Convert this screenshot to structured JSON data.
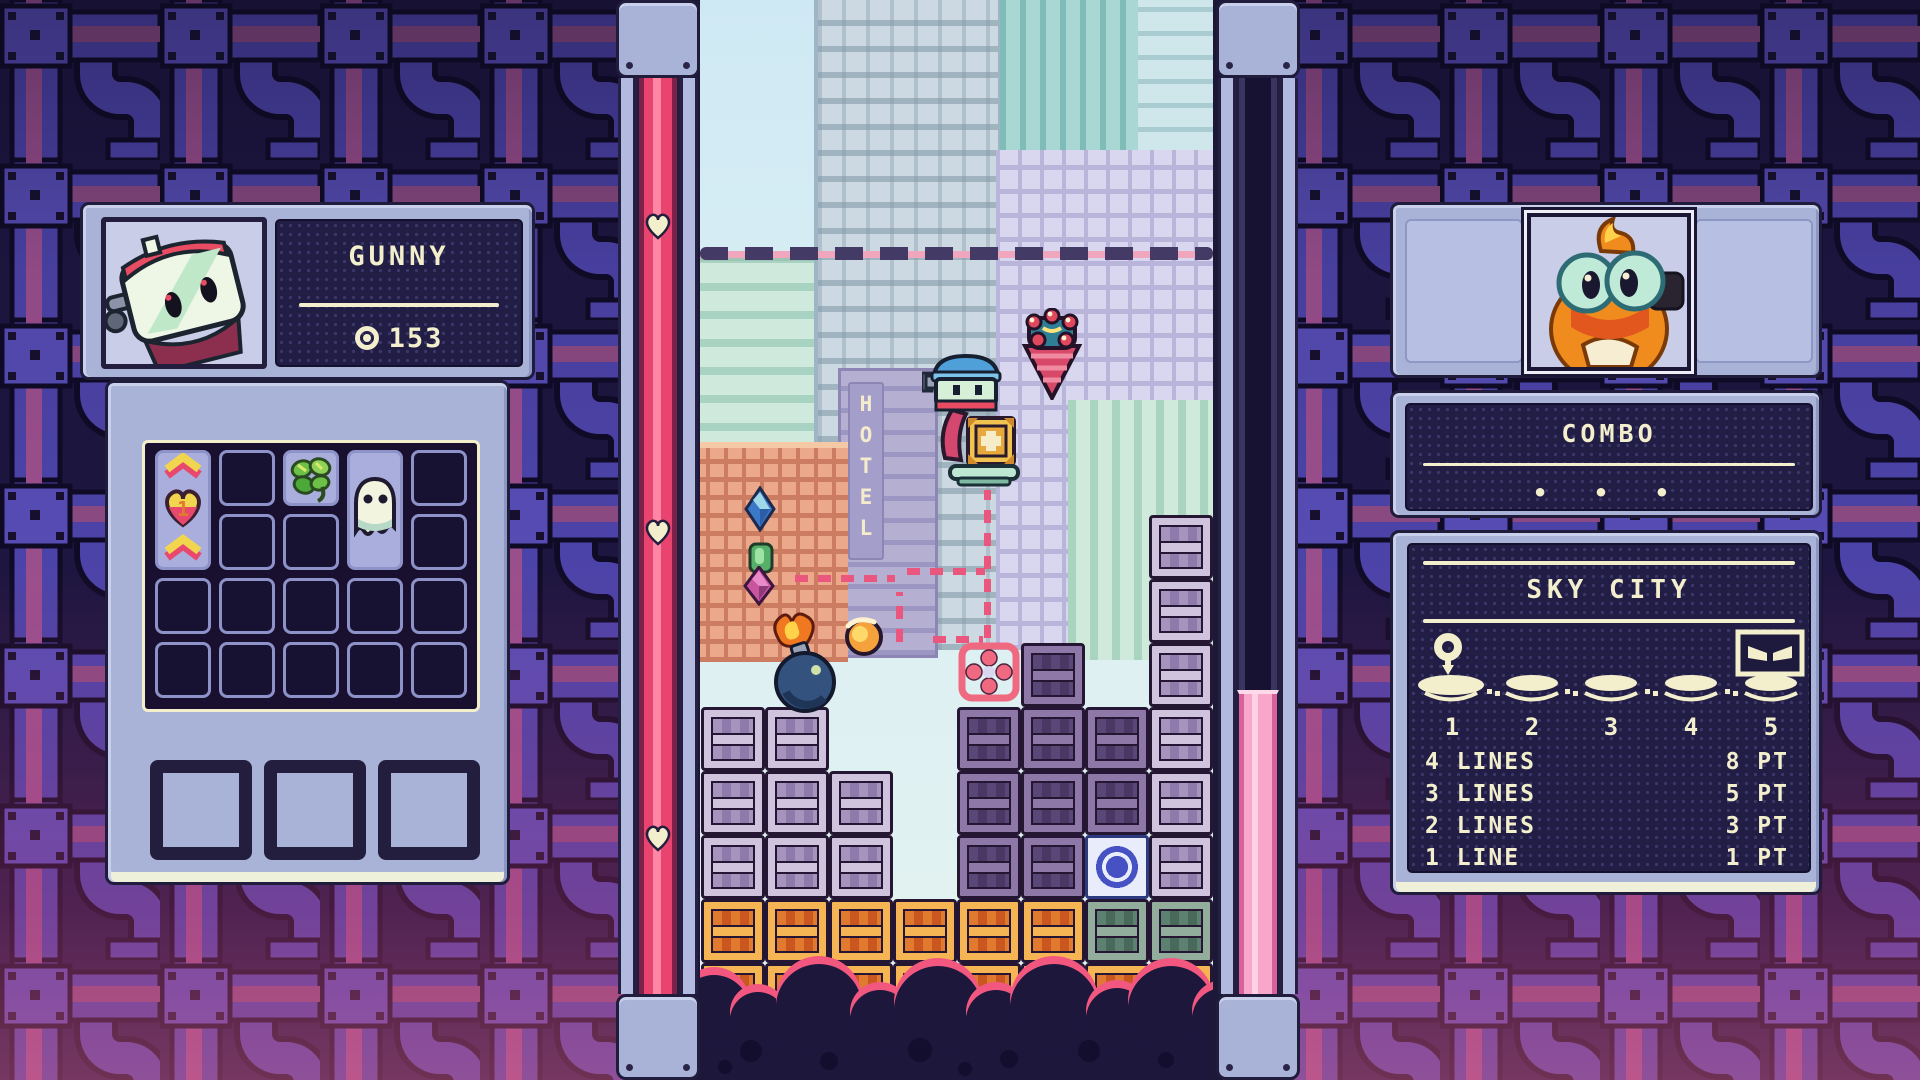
{
  "left_player": {
    "name": "GUNNY",
    "score": "153",
    "score_icon": "target-coin-icon",
    "heart_item_value": "1",
    "inventory_items": [
      "boost-chevrons-heart",
      "clover",
      "ghost"
    ]
  },
  "right_player": {
    "combo_label": "COMBO",
    "combo_dots": "•  •  •"
  },
  "stage": {
    "name": "SKY CITY",
    "checkpoints": [
      "1",
      "2",
      "3",
      "4",
      "5"
    ],
    "current_checkpoint": "1",
    "boss_at": "5",
    "scoring": [
      {
        "lines": "4 LINES",
        "points": "8 PT"
      },
      {
        "lines": "3 LINES",
        "points": "5 PT"
      },
      {
        "lines": "2 LINES",
        "points": "3 PT"
      },
      {
        "lines": "1 LINE",
        "points": "1 PT"
      }
    ]
  },
  "meters": {
    "left": {
      "type": "health-meter",
      "hearts": 3,
      "fill": "full-pink"
    },
    "right": {
      "type": "charge-meter",
      "fill_percent": 33,
      "fill": "pink-bottom"
    }
  },
  "field": {
    "hotel_sign": "HOTEL",
    "entities": [
      "player-robot",
      "plus-crate",
      "hover-platform",
      "drill-item",
      "bomb",
      "fireball",
      "gem-blue",
      "gem-green",
      "gem-pink",
      "target-reticle",
      "drop-path",
      "danger-line"
    ],
    "board": {
      "cols": 8,
      "block_types": {
        "lp": "light-purple",
        "dp": "dark-purple",
        "or": "orange",
        "gr": "green",
        "sp": "blue-special"
      },
      "blocks": [
        [
          1,
          3,
          "lp"
        ],
        [
          1,
          4,
          "lp"
        ],
        [
          1,
          5,
          "lp"
        ],
        [
          1,
          6,
          "or"
        ],
        [
          1,
          7,
          "or"
        ],
        [
          2,
          3,
          "lp"
        ],
        [
          2,
          4,
          "lp"
        ],
        [
          2,
          5,
          "lp"
        ],
        [
          2,
          6,
          "or"
        ],
        [
          2,
          7,
          "or"
        ],
        [
          3,
          4,
          "lp"
        ],
        [
          3,
          5,
          "lp"
        ],
        [
          3,
          6,
          "or"
        ],
        [
          3,
          7,
          "or"
        ],
        [
          4,
          6,
          "or"
        ],
        [
          4,
          7,
          "or"
        ],
        [
          5,
          3,
          "dp"
        ],
        [
          5,
          4,
          "dp"
        ],
        [
          5,
          5,
          "dp"
        ],
        [
          5,
          6,
          "or"
        ],
        [
          5,
          7,
          "or"
        ],
        [
          6,
          2,
          "dp"
        ],
        [
          6,
          3,
          "dp"
        ],
        [
          6,
          4,
          "dp"
        ],
        [
          6,
          5,
          "dp"
        ],
        [
          6,
          6,
          "or"
        ],
        [
          6,
          7,
          "or"
        ],
        [
          7,
          3,
          "dp"
        ],
        [
          7,
          4,
          "dp"
        ],
        [
          7,
          5,
          "sp"
        ],
        [
          7,
          6,
          "gr"
        ],
        [
          7,
          7,
          "or"
        ],
        [
          8,
          0,
          "lp"
        ],
        [
          8,
          1,
          "lp"
        ],
        [
          8,
          2,
          "lp"
        ],
        [
          8,
          3,
          "lp"
        ],
        [
          8,
          4,
          "lp"
        ],
        [
          8,
          5,
          "lp"
        ],
        [
          8,
          6,
          "gr"
        ],
        [
          8,
          7,
          "or"
        ]
      ]
    },
    "clouds": {
      "bumps": [
        [
          -22,
          975,
          72
        ],
        [
          30,
          992,
          56
        ],
        [
          76,
          964,
          86
        ],
        [
          150,
          990,
          60
        ],
        [
          194,
          966,
          88
        ],
        [
          266,
          990,
          60
        ],
        [
          310,
          964,
          88
        ],
        [
          386,
          988,
          62
        ],
        [
          428,
          966,
          86
        ],
        [
          492,
          988,
          62
        ]
      ],
      "dots": [
        [
          40,
          1040,
          22
        ],
        [
          120,
          1052,
          18
        ],
        [
          208,
          1038,
          24
        ],
        [
          300,
          1050,
          18
        ],
        [
          378,
          1040,
          22
        ],
        [
          458,
          1052,
          16
        ],
        [
          18,
          1060,
          14
        ],
        [
          258,
          1062,
          14
        ]
      ]
    }
  },
  "colors": {
    "cream": "#f3eecb",
    "steel": "#a9b3d8",
    "navy_plate": "#211d45",
    "accent_pink": "#e9577f",
    "meter_pink": "#f0507e",
    "bg_pipe_blue": "#4c43a8",
    "bg_pipe_magenta": "#9a4f8d"
  }
}
